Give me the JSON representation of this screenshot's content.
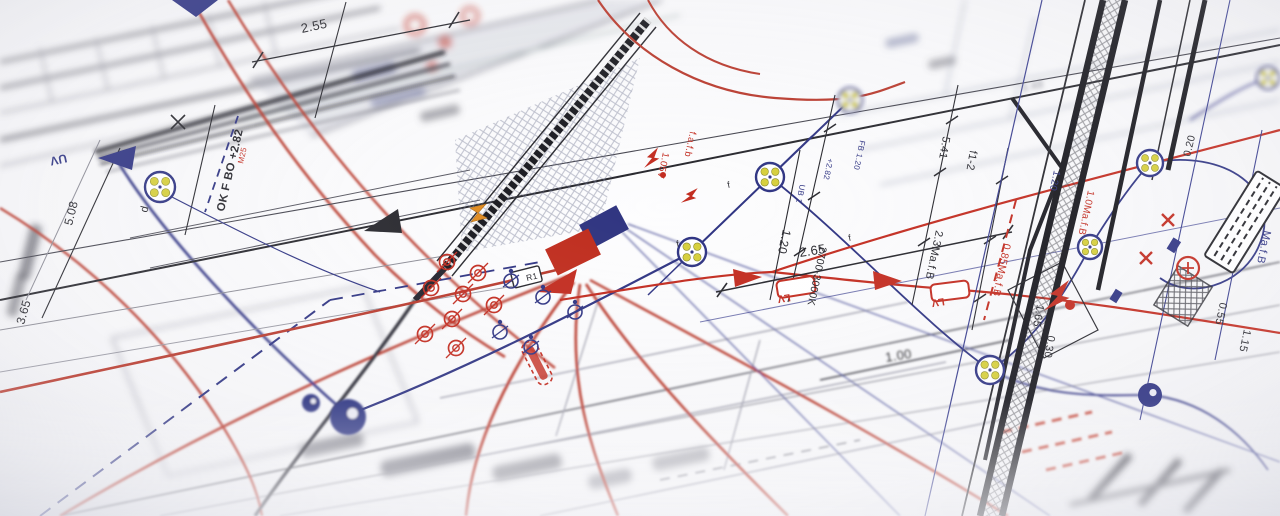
{
  "meta": {
    "description": "Angled close-up photograph of a printed electrical installation blueprint with red and navy ink wiring runs, luminaire symbols, dimension chains and hatched wall sections; shallow depth of field blurs the edges of the sheet."
  },
  "colors": {
    "ink": "#26262c",
    "navy": "#2e3382",
    "red": "#c22b1f",
    "gray": "#8b8b95",
    "yellow": "#d6cf3a",
    "orange": "#e08a1e",
    "paper": "#fafafb"
  },
  "diagram": {
    "annotations": [
      {
        "t": "2.55",
        "x": 302,
        "y": 33,
        "r": -12,
        "s": 13,
        "c": "ink"
      },
      {
        "t": "OK F BO +2.82",
        "x": 224,
        "y": 212,
        "r": -77,
        "s": 11.5,
        "c": "ink",
        "b": 1
      },
      {
        "t": "M25",
        "x": 243,
        "y": 164,
        "r": -77,
        "s": 8,
        "c": "red"
      },
      {
        "t": "5.08",
        "x": 72,
        "y": 226,
        "r": -76,
        "s": 12,
        "c": "ink"
      },
      {
        "t": "d",
        "x": 147,
        "y": 213,
        "r": -76,
        "s": 11,
        "c": "ink"
      },
      {
        "t": "3.65",
        "x": 24,
        "y": 325,
        "r": -74,
        "s": 12,
        "c": "ink"
      },
      {
        "t": "2.65",
        "x": 800,
        "y": 257,
        "r": -9,
        "s": 13,
        "c": "ink"
      },
      {
        "t": "1.00",
        "x": 886,
        "y": 362,
        "r": -9,
        "s": 13,
        "c": "ink",
        "f": 1
      },
      {
        "t": "f1-2",
        "x": 970,
        "y": 150,
        "r": 100,
        "s": 11,
        "c": "ink"
      },
      {
        "t": "5.41",
        "x": 943,
        "y": 136,
        "r": 100,
        "s": 11,
        "c": "ink"
      },
      {
        "t": "2.3Ma.f.B",
        "x": 936,
        "y": 230,
        "r": 102,
        "s": 11,
        "c": "ink"
      },
      {
        "t": "0.85Ma.f.B",
        "x": 1004,
        "y": 243,
        "r": 102,
        "s": 10.5,
        "c": "red"
      },
      {
        "t": "2700-3000K",
        "x": 820,
        "y": 246,
        "r": 102,
        "s": 10.5,
        "c": "ink"
      },
      {
        "t": "1.20",
        "x": 783,
        "y": 229,
        "r": 102,
        "s": 12,
        "c": "ink"
      },
      {
        "t": "FB 1.20",
        "x": 860,
        "y": 140,
        "r": 102,
        "s": 8,
        "c": "navy"
      },
      {
        "t": "UB 1",
        "x": 800,
        "y": 184,
        "r": 102,
        "s": 8,
        "c": "navy"
      },
      {
        "t": "+2.82",
        "x": 828,
        "y": 158,
        "r": 102,
        "s": 8,
        "c": "navy"
      },
      {
        "t": "1.05V",
        "x": 663,
        "y": 152,
        "r": 102,
        "s": 9.5,
        "c": "red"
      },
      {
        "t": "f.a.f.b",
        "x": 690,
        "y": 131,
        "r": 102,
        "s": 9.5,
        "c": "red"
      },
      {
        "t": "1.0Ma.f.B",
        "x": 1088,
        "y": 190,
        "r": 102,
        "s": 10,
        "c": "red"
      },
      {
        "t": "Ma.f.B",
        "x": 1264,
        "y": 230,
        "r": 102,
        "s": 11,
        "c": "navy"
      },
      {
        "t": "0.20",
        "x": 1190,
        "y": 157,
        "r": -76,
        "s": 10.5,
        "c": "ink"
      },
      {
        "t": "0.55",
        "x": 1220,
        "y": 302,
        "r": 102,
        "s": 11,
        "c": "ink"
      },
      {
        "t": "1.15",
        "x": 1244,
        "y": 329,
        "r": 102,
        "s": 11,
        "c": "ink"
      },
      {
        "t": "1.65",
        "x": 1037,
        "y": 304,
        "r": 100,
        "s": 11,
        "c": "ink"
      },
      {
        "t": "0.30",
        "x": 1048,
        "y": 335,
        "r": 100,
        "s": 11,
        "c": "ink"
      },
      {
        "t": "3.48",
        "x": 1022,
        "y": 92,
        "r": -12,
        "s": 11,
        "c": "gray",
        "f": 2
      },
      {
        "t": "f",
        "x": 728,
        "y": 188,
        "r": -12,
        "s": 9,
        "c": "ink"
      },
      {
        "t": "f",
        "x": 677,
        "y": 247,
        "r": -12,
        "s": 9,
        "c": "ink"
      },
      {
        "t": "f",
        "x": 849,
        "y": 241,
        "r": -12,
        "s": 9,
        "c": "ink"
      },
      {
        "t": "1.20",
        "x": 1054,
        "y": 170,
        "r": 102,
        "s": 10,
        "c": "navy"
      },
      {
        "t": "UV",
        "x": 66,
        "y": 154,
        "r": 168,
        "s": 12,
        "c": "navy",
        "b": 1
      },
      {
        "t": "R1",
        "x": 527,
        "y": 281,
        "r": -14,
        "s": 8.5,
        "c": "ink"
      },
      {
        "t": "LV",
        "x": 790,
        "y": 294,
        "r": 171,
        "s": 10.5,
        "c": "red",
        "b": 1
      },
      {
        "t": "LV",
        "x": 944,
        "y": 298,
        "r": 171,
        "s": 10.5,
        "c": "red",
        "b": 1
      }
    ],
    "lv_boxes": [
      {
        "x": 796,
        "y": 287,
        "r": -9
      },
      {
        "x": 950,
        "y": 291,
        "r": -7
      }
    ],
    "luminaires": [
      {
        "x": 160,
        "y": 187,
        "rad": 15
      },
      {
        "x": 692,
        "y": 252,
        "rad": 14
      },
      {
        "x": 770,
        "y": 177,
        "rad": 14
      },
      {
        "x": 850,
        "y": 100,
        "rad": 12,
        "f": 2
      },
      {
        "x": 990,
        "y": 370,
        "rad": 14
      },
      {
        "x": 1150,
        "y": 163,
        "rad": 13
      },
      {
        "x": 1090,
        "y": 247,
        "rad": 12
      },
      {
        "x": 1268,
        "y": 78,
        "rad": 11,
        "f": 2
      }
    ],
    "red_spots": [
      [
        447,
        262
      ],
      [
        478,
        273
      ],
      [
        431,
        288
      ],
      [
        463,
        294
      ],
      [
        494,
        305
      ],
      [
        452,
        319
      ],
      [
        425,
        334
      ],
      [
        456,
        348
      ]
    ],
    "navy_spots": [
      [
        511,
        281
      ],
      [
        543,
        297
      ],
      [
        500,
        332
      ],
      [
        531,
        347
      ],
      [
        575,
        312
      ]
    ],
    "navy_blobs": [
      {
        "x": 348,
        "y": 417,
        "rad": 18,
        "f": 1
      },
      {
        "x": 311,
        "y": 403,
        "rad": 9,
        "f": 1
      },
      {
        "x": 1150,
        "y": 395,
        "rad": 12
      }
    ],
    "x_marks": [
      [
        1168,
        220
      ],
      [
        1146,
        258
      ]
    ],
    "bolts": [
      {
        "x": 652,
        "y": 158,
        "r": 20,
        "sc": 1
      },
      {
        "x": 690,
        "y": 196,
        "r": 35,
        "sc": 0.9
      },
      {
        "x": 1058,
        "y": 296,
        "r": 25,
        "sc": 1.6
      }
    ],
    "red_dots": [
      [
        1070,
        305,
        5
      ],
      [
        663,
        175,
        3
      ]
    ],
    "squares": [
      {
        "x": 604,
        "y": 227,
        "w": 42,
        "h": 27,
        "r": -28,
        "c": "#2f3480"
      },
      {
        "x": 573,
        "y": 252,
        "w": 48,
        "h": 29,
        "r": -26,
        "c": "#bf2c1d"
      }
    ],
    "triangles": [
      {
        "p": "98,158 136,146 132,170",
        "c": "navy"
      },
      {
        "p": "172,0 218,0 196,17",
        "c": "navy"
      },
      {
        "p": "364,231 398,209 402,233",
        "c": "ink"
      },
      {
        "p": "537,292 577,269 571,294",
        "c": "red"
      },
      {
        "p": "762,277 733,269 735,287",
        "c": "red"
      },
      {
        "p": "902,281 873,271 875,290",
        "c": "red"
      }
    ],
    "orange_marks": [
      {
        "x": 478,
        "y": 213
      }
    ]
  }
}
